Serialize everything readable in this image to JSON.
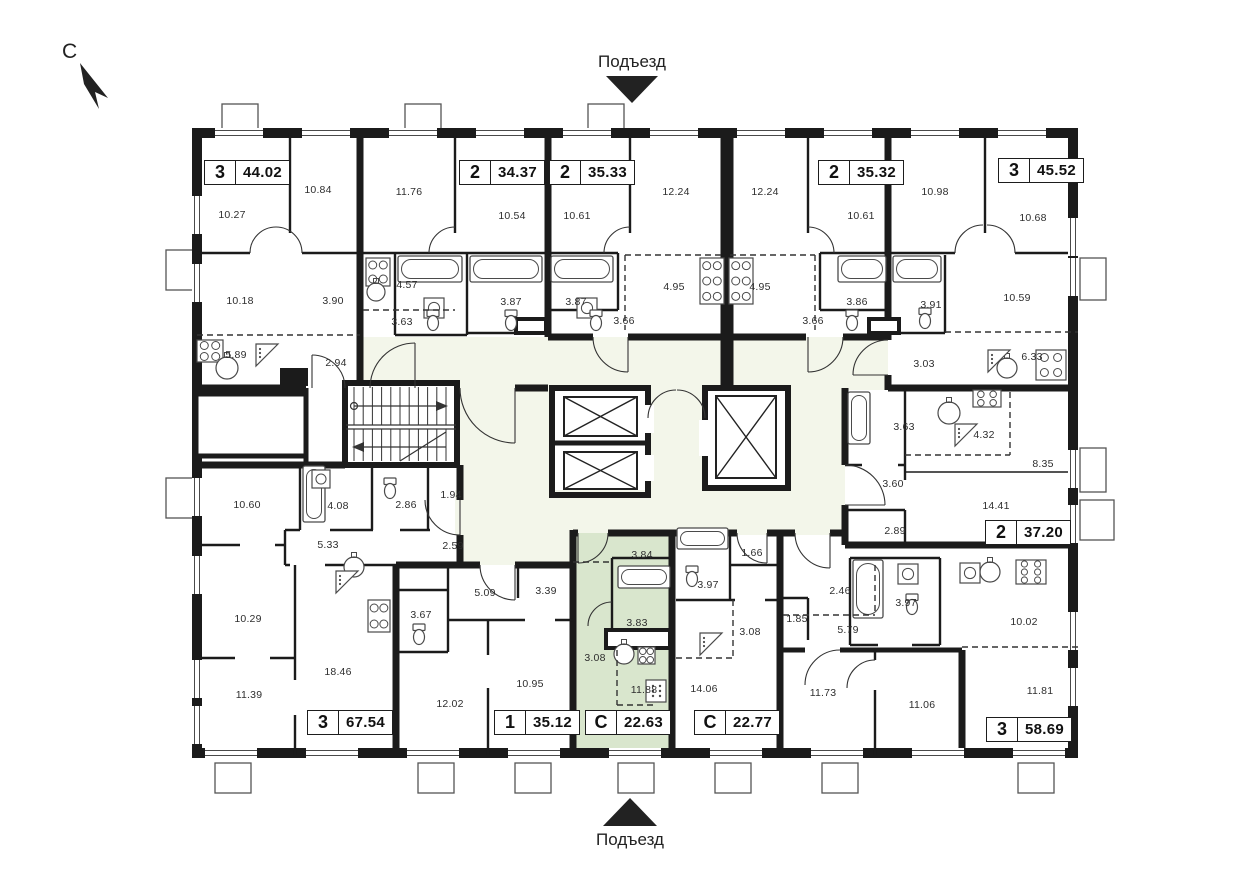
{
  "compass": {
    "label": "С"
  },
  "entrances": {
    "top": "Подъезд",
    "bottom": "Подъезд"
  },
  "colors": {
    "wall": "#1b1b1b",
    "highlight": "#d9e6cd",
    "corridor": "#f3f6ea",
    "fixture": "#4a4a4a",
    "text": "#2e2e2e"
  },
  "apartments": [
    {
      "type": "3",
      "area": "44.02",
      "highlighted": false,
      "badge": {
        "x": 204,
        "y": 160
      },
      "rooms": [
        {
          "v": "10.27",
          "x": 232,
          "y": 215
        },
        {
          "v": "10.84",
          "x": 318,
          "y": 190
        },
        {
          "v": "10.18",
          "x": 240,
          "y": 301
        },
        {
          "v": "3.90",
          "x": 333,
          "y": 301
        },
        {
          "v": "5.89",
          "x": 236,
          "y": 355
        },
        {
          "v": "2.94",
          "x": 336,
          "y": 363
        }
      ]
    },
    {
      "type": "2",
      "area": "34.37",
      "highlighted": false,
      "badge": {
        "x": 459,
        "y": 160
      },
      "rooms": [
        {
          "v": "11.76",
          "x": 409,
          "y": 192
        },
        {
          "v": "10.54",
          "x": 512,
          "y": 216
        },
        {
          "v": "4.57",
          "x": 407,
          "y": 285
        },
        {
          "v": "3.63",
          "x": 402,
          "y": 322
        },
        {
          "v": "3.87",
          "x": 511,
          "y": 302
        }
      ]
    },
    {
      "type": "2",
      "area": "35.33",
      "highlighted": false,
      "badge": {
        "x": 549,
        "y": 160
      },
      "rooms": [
        {
          "v": "10.61",
          "x": 577,
          "y": 216
        },
        {
          "v": "12.24",
          "x": 676,
          "y": 192
        },
        {
          "v": "4.95",
          "x": 674,
          "y": 287
        },
        {
          "v": "3.87",
          "x": 576,
          "y": 302
        },
        {
          "v": "3.66",
          "x": 624,
          "y": 321
        }
      ]
    },
    {
      "type": "2",
      "area": "35.32",
      "highlighted": false,
      "badge": {
        "x": 818,
        "y": 160
      },
      "rooms": [
        {
          "v": "12.24",
          "x": 765,
          "y": 192
        },
        {
          "v": "10.61",
          "x": 861,
          "y": 216
        },
        {
          "v": "4.95",
          "x": 760,
          "y": 287
        },
        {
          "v": "3.86",
          "x": 857,
          "y": 302
        },
        {
          "v": "3.66",
          "x": 813,
          "y": 321
        }
      ]
    },
    {
      "type": "3",
      "area": "45.52",
      "highlighted": false,
      "badge": {
        "x": 998,
        "y": 158
      },
      "rooms": [
        {
          "v": "10.98",
          "x": 935,
          "y": 192
        },
        {
          "v": "10.68",
          "x": 1033,
          "y": 218
        },
        {
          "v": "10.59",
          "x": 1017,
          "y": 298
        },
        {
          "v": "3.91",
          "x": 931,
          "y": 305
        },
        {
          "v": "3.03",
          "x": 924,
          "y": 364
        },
        {
          "v": "6.33",
          "x": 1032,
          "y": 357
        }
      ]
    },
    {
      "type": "2",
      "area": "37.20",
      "highlighted": false,
      "badge": {
        "x": 985,
        "y": 520
      },
      "rooms": [
        {
          "v": "3.63",
          "x": 904,
          "y": 427
        },
        {
          "v": "4.32",
          "x": 984,
          "y": 435
        },
        {
          "v": "8.35",
          "x": 1043,
          "y": 464
        },
        {
          "v": "14.41",
          "x": 996,
          "y": 506
        },
        {
          "v": "3.60",
          "x": 893,
          "y": 484
        },
        {
          "v": "2.89",
          "x": 895,
          "y": 531
        }
      ]
    },
    {
      "type": "3",
      "area": "67.54",
      "highlighted": false,
      "badge": {
        "x": 307,
        "y": 710
      },
      "rooms": [
        {
          "v": "10.60",
          "x": 247,
          "y": 505
        },
        {
          "v": "4.08",
          "x": 338,
          "y": 506
        },
        {
          "v": "2.86",
          "x": 406,
          "y": 505
        },
        {
          "v": "1.94",
          "x": 451,
          "y": 495
        },
        {
          "v": "5.33",
          "x": 328,
          "y": 545
        },
        {
          "v": "2.59",
          "x": 453,
          "y": 546
        },
        {
          "v": "10.29",
          "x": 248,
          "y": 619
        },
        {
          "v": "11.39",
          "x": 249,
          "y": 695
        },
        {
          "v": "18.46",
          "x": 338,
          "y": 672
        }
      ]
    },
    {
      "type": "1",
      "area": "35.12",
      "highlighted": false,
      "badge": {
        "x": 494,
        "y": 710
      },
      "rooms": [
        {
          "v": "5.09",
          "x": 485,
          "y": 593
        },
        {
          "v": "3.39",
          "x": 546,
          "y": 591
        },
        {
          "v": "3.67",
          "x": 421,
          "y": 615
        },
        {
          "v": "12.02",
          "x": 450,
          "y": 704
        },
        {
          "v": "10.95",
          "x": 530,
          "y": 684
        }
      ]
    },
    {
      "type": "С",
      "area": "22.63",
      "highlighted": true,
      "badge": {
        "x": 585,
        "y": 710
      },
      "rooms": [
        {
          "v": "3.84",
          "x": 642,
          "y": 555
        },
        {
          "v": "3.83",
          "x": 637,
          "y": 623
        },
        {
          "v": "3.08",
          "x": 595,
          "y": 658
        },
        {
          "v": "11.88",
          "x": 644,
          "y": 690
        }
      ]
    },
    {
      "type": "С",
      "area": "22.77",
      "highlighted": false,
      "badge": {
        "x": 694,
        "y": 710
      },
      "rooms": [
        {
          "v": "1.66",
          "x": 752,
          "y": 553
        },
        {
          "v": "3.97",
          "x": 708,
          "y": 585
        },
        {
          "v": "3.08",
          "x": 750,
          "y": 632
        },
        {
          "v": "14.06",
          "x": 704,
          "y": 689
        }
      ]
    },
    {
      "type": "3",
      "area": "58.69",
      "highlighted": false,
      "badge": {
        "x": 986,
        "y": 717
      },
      "rooms": [
        {
          "v": "2.46",
          "x": 840,
          "y": 591
        },
        {
          "v": "1.85",
          "x": 797,
          "y": 619
        },
        {
          "v": "5.79",
          "x": 848,
          "y": 630
        },
        {
          "v": "3.97",
          "x": 906,
          "y": 603
        },
        {
          "v": "10.02",
          "x": 1024,
          "y": 622
        },
        {
          "v": "11.73",
          "x": 823,
          "y": 693
        },
        {
          "v": "11.06",
          "x": 922,
          "y": 705
        },
        {
          "v": "11.81",
          "x": 1040,
          "y": 691
        }
      ]
    }
  ]
}
